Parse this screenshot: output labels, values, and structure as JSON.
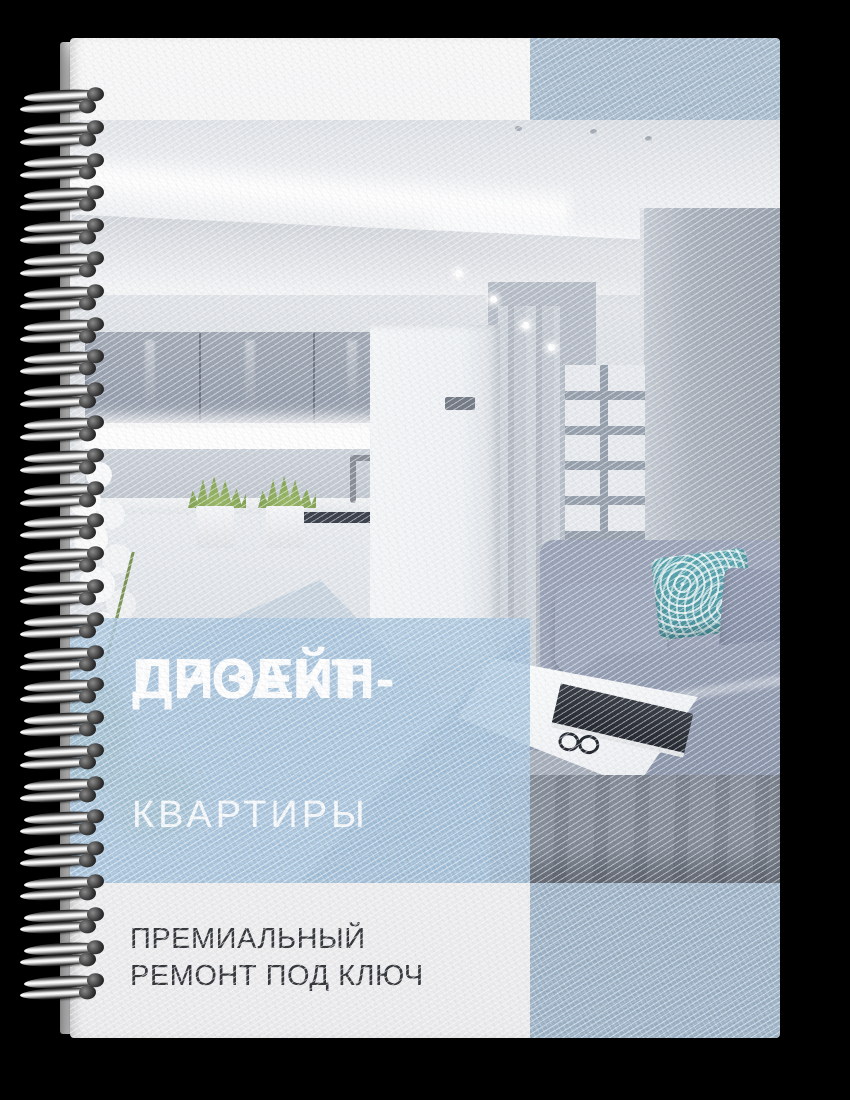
{
  "cover": {
    "title_line1": "ДИЗАЙН-",
    "title_line2": "ПРОЕКТ",
    "subtitle": "КВАРТИРЫ",
    "tagline_line1": "ПРЕМИАЛЬНЫЙ",
    "tagline_line2": "РЕМОНТ ПОД КЛЮЧ"
  },
  "colors": {
    "background": "#000000",
    "cover_white": "#f3f3f4",
    "accent_blue_top_block": "#a5bacd",
    "accent_blue_title_band": "#a4c2dc",
    "accent_blue_bottom_block": "#9bb1c6",
    "title_text": "#ffffff",
    "tagline_text": "#36393d",
    "teal_pillow": "#4f97a2"
  },
  "binding": {
    "coil_count": 28,
    "coil_start_y": 90,
    "coil_pitch": 32.8
  }
}
